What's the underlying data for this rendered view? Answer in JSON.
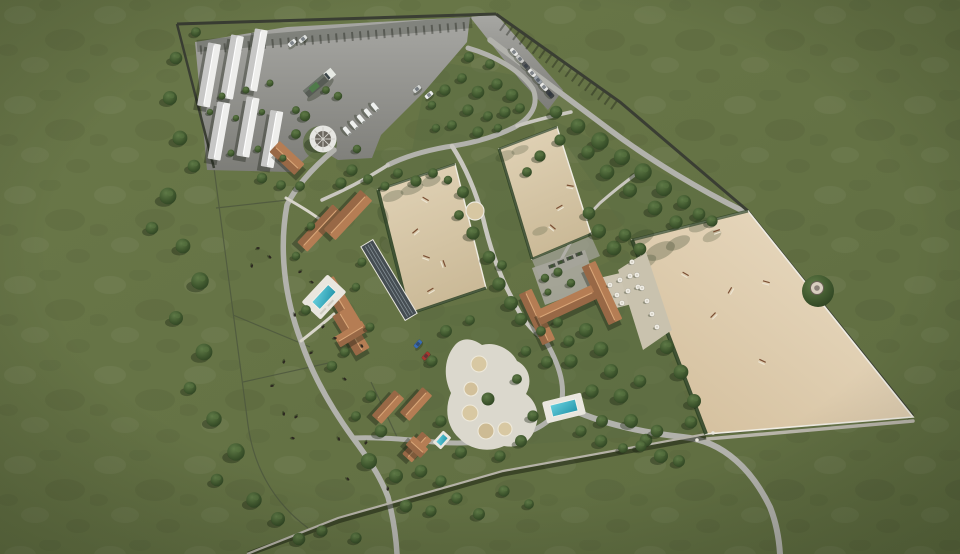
{
  "meta": {
    "description": "Aerial 3D architectural rendering of a walled equestrian estate masterplan: white stable barns and a gray parking yard with truck and horse trailers at the top left, two sand riding arenas in the center, one large sand grand arena on the right, a U-shaped terracotta-roof clubhouse, terracotta stable and villa buildings, swimming pools, round lunging pens, a covered horse walker, tree-lined paths and paddocks with grazing horses, all surrounded by olive-green grassland.",
    "width": 960,
    "height": 554
  },
  "colors": {
    "grass_base": "#657345",
    "grass_light": "#6f7c4e",
    "grass_dark": "#55653c",
    "lawn": "#5d6e43",
    "tree": "#3c5230",
    "tree_dark": "#2b3e20",
    "tree_light": "#5a7442",
    "shadow": "#1a2412",
    "sand": "#ddd0b2",
    "sand_dark": "#c9b894",
    "sand_big": "#e7d9c0",
    "sand_big_dark": "#d5c19f",
    "pavement": "#9c9c98",
    "pavement_dark": "#7e7e79",
    "road": "#b2b2ac",
    "path": "#d8d5ca",
    "wall": "#3a3e33",
    "fence": "#efece2",
    "hedge": "#2e4224",
    "roof_white": "#eeeeec",
    "roof_white_shade": "#c7c7c3",
    "terracotta": "#b57d54",
    "terracotta_shade": "#8f5c3b",
    "ridge": "#d9a678",
    "water": "#2fadc4",
    "water_light": "#66cfdd",
    "deck": "#e9e6de",
    "structure_dark": "#454d52",
    "structure_line": "#848f95",
    "car_blue": "#3a6db5",
    "car_red": "#a8372f"
  },
  "scene": {
    "label": "equestrian-estate-masterplan",
    "features": {
      "perimeter_wall": "stone wall with posts",
      "white_stable_barns": 6,
      "terracotta_buildings": 9,
      "clubhouse": "U-shaped terracotta roof building",
      "arenas": 3,
      "round_pens": 5,
      "lunging_ring": 1,
      "horse_walker": 1,
      "swimming_pools": 3,
      "parking_yard_vehicles": "truck, horse trailers, parked cars",
      "paddocks_with_horses": true
    }
  }
}
